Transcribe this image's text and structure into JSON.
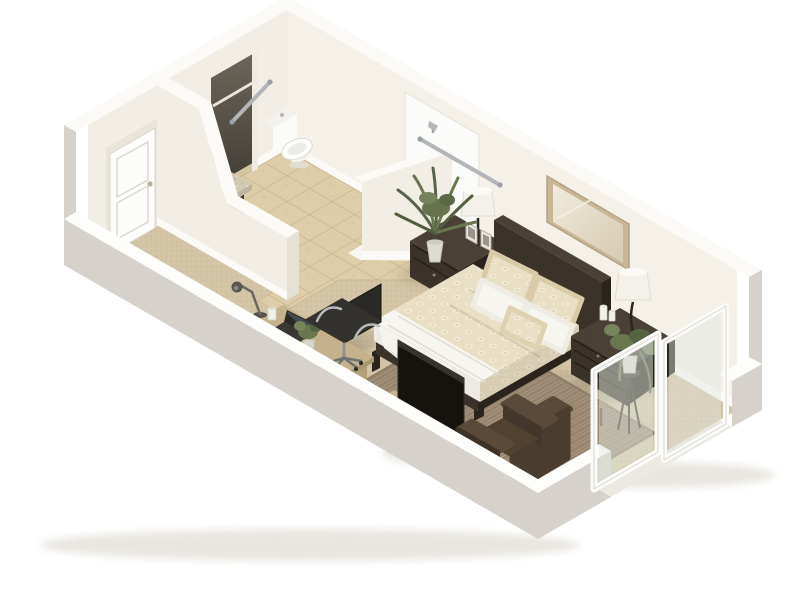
{
  "scene": {
    "background": "#ffffff",
    "view": "isometric-cutaway-floorplan"
  },
  "palette": {
    "wall": "#f2eee5",
    "wall_warm": "#f5f1e8",
    "wall_top": "#fbfaf6",
    "wall_gray": "#d6d2cb",
    "wall_gray2": "#cbc7c0",
    "baseboard": "#fdfdfb",
    "carpet": "#d3c4a6",
    "tile": "#decda9",
    "rug": "#a3907a",
    "wood_dark": "#3b332a",
    "wood_darker": "#2b241d",
    "wood_mid": "#4a4036",
    "wood_light": "#c5b28c",
    "wood_light_shade": "#b2a07b",
    "granite": "#d2c8b4",
    "fixture_white": "#fbfbf9",
    "chrome": "#b2b6b8",
    "duvet": "#e9dfc5",
    "linen": "#f7f5ef",
    "lamp_shade": "#f3f1ea",
    "mirror_frame": "#c8b697",
    "mirror_glass": "#ece5d4",
    "armchair": "#4a3c2f",
    "armchair_dark": "#3e3226",
    "armchair_light": "#5a4a3a",
    "chair_black": "#2b2926",
    "tv_black": "#16130f",
    "glass": "#dfe7dd",
    "plant_green": "#69774f",
    "plant_green_dark": "#525f3e",
    "pot": "#dedbd2",
    "door_white": "#fcfcfa"
  },
  "rooms": [
    {
      "name": "bathroom",
      "floor": "ceramic-tile"
    },
    {
      "name": "bedroom-living-area",
      "floor": "carpet"
    }
  ],
  "objects": [
    {
      "name": "entry-door",
      "label": "white panel entry door"
    },
    {
      "name": "closet",
      "label": "closet nook with shelf"
    },
    {
      "name": "vanity",
      "label": "dark vanity with granite top and sink"
    },
    {
      "name": "toilet",
      "label": "white toilet"
    },
    {
      "name": "walk-in-shower",
      "label": "accessible walk-in shower with showerhead"
    },
    {
      "name": "grab-bars",
      "label": "two chrome safety grab bars",
      "count": 2
    },
    {
      "name": "bathroom-half-wall",
      "label": "angled bathroom partition wall"
    },
    {
      "name": "wall-mirror",
      "label": "framed mirror above headboard"
    },
    {
      "name": "bed",
      "label": "queen bed with patterned duvet",
      "pillow_count": 5
    },
    {
      "name": "nightstand-left",
      "label": "dark nightstand with lamp and photo frames"
    },
    {
      "name": "nightstand-right",
      "label": "dark nightstand with lamp and candles"
    },
    {
      "name": "area-rug",
      "label": "woven brown area rug"
    },
    {
      "name": "media-console",
      "label": "light wood media console"
    },
    {
      "name": "television",
      "label": "flat screen TV on stand"
    },
    {
      "name": "desk",
      "label": "light wood desk with lamp, laptop and plant"
    },
    {
      "name": "office-chair",
      "label": "black office chair with chrome base"
    },
    {
      "name": "armchair",
      "label": "brown upholstered armchair"
    },
    {
      "name": "palm-plant",
      "label": "large potted palm"
    },
    {
      "name": "plant-stand",
      "label": "potted plant on pedestal stand"
    },
    {
      "name": "sliding-glass-door",
      "label": "white sliding glass patio door",
      "panels": 2
    }
  ]
}
